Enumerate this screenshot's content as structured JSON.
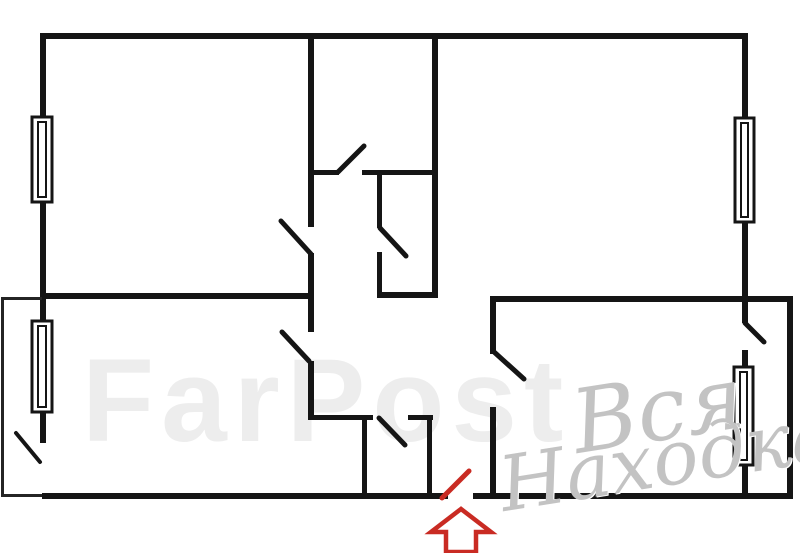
{
  "canvas": {
    "width": 800,
    "height": 553,
    "background": "#ffffff"
  },
  "colors": {
    "wall": "#151515",
    "balcony_line": "#242424",
    "entrance_red": "#c92b23",
    "logo_gray": "#c3c3c3",
    "faint_gray": "#ededed",
    "window_fill": "#ffffff"
  },
  "watermarks": {
    "faint_text": "FarPost",
    "logo_line1": "Вся",
    "logo_line2": "Находка"
  },
  "floorplan": {
    "walls": [
      {
        "x": 42,
        "y": 33,
        "w": 706,
        "h": 6
      },
      {
        "x": 40,
        "y": 33,
        "w": 6,
        "h": 410
      },
      {
        "x": 42,
        "y": 293,
        "w": 271,
        "h": 6
      },
      {
        "x": 308,
        "y": 33,
        "w": 6,
        "h": 194
      },
      {
        "x": 308,
        "y": 253,
        "w": 6,
        "h": 79
      },
      {
        "x": 308,
        "y": 361,
        "w": 6,
        "h": 59
      },
      {
        "x": 308,
        "y": 170,
        "w": 31,
        "h": 5
      },
      {
        "x": 362,
        "y": 170,
        "w": 75,
        "h": 5
      },
      {
        "x": 377,
        "y": 172,
        "w": 5,
        "h": 56
      },
      {
        "x": 377,
        "y": 252,
        "w": 5,
        "h": 46
      },
      {
        "x": 377,
        "y": 292,
        "w": 60,
        "h": 6
      },
      {
        "x": 432,
        "y": 33,
        "w": 6,
        "h": 265
      },
      {
        "x": 742,
        "y": 33,
        "w": 6,
        "h": 290
      },
      {
        "x": 742,
        "y": 350,
        "w": 6,
        "h": 145
      },
      {
        "x": 490,
        "y": 296,
        "w": 303,
        "h": 6
      },
      {
        "x": 490,
        "y": 296,
        "w": 6,
        "h": 58
      },
      {
        "x": 490,
        "y": 407,
        "w": 6,
        "h": 92
      },
      {
        "x": 787,
        "y": 298,
        "w": 6,
        "h": 201
      },
      {
        "x": 42,
        "y": 493,
        "w": 406,
        "h": 6
      },
      {
        "x": 473,
        "y": 493,
        "w": 320,
        "h": 6
      },
      {
        "x": 308,
        "y": 415,
        "w": 65,
        "h": 5
      },
      {
        "x": 408,
        "y": 415,
        "w": 25,
        "h": 5
      },
      {
        "x": 362,
        "y": 418,
        "w": 5,
        "h": 77
      },
      {
        "x": 427,
        "y": 415,
        "w": 5,
        "h": 84
      }
    ],
    "balcony_lines": [
      {
        "x": 1,
        "y": 297,
        "w": 3,
        "h": 200
      },
      {
        "x": 1,
        "y": 297,
        "w": 41,
        "h": 3
      },
      {
        "x": 1,
        "y": 494,
        "w": 41,
        "h": 3
      }
    ],
    "windows": [
      {
        "x": 32,
        "y": 117,
        "w": 20,
        "h": 85
      },
      {
        "x": 32,
        "y": 321,
        "w": 20,
        "h": 91
      },
      {
        "x": 735,
        "y": 118,
        "w": 19,
        "h": 104
      },
      {
        "x": 734,
        "y": 367,
        "w": 19,
        "h": 98
      }
    ],
    "door_leaves": [
      {
        "x1": 338,
        "y1": 172,
        "x2": 364,
        "y2": 146,
        "w": 5
      },
      {
        "x1": 281,
        "y1": 221,
        "x2": 311,
        "y2": 254,
        "w": 5
      },
      {
        "x1": 380,
        "y1": 228,
        "x2": 406,
        "y2": 256,
        "w": 5
      },
      {
        "x1": 282,
        "y1": 332,
        "x2": 309,
        "y2": 361,
        "w": 5
      },
      {
        "x1": 379,
        "y1": 418,
        "x2": 405,
        "y2": 445,
        "w": 5
      },
      {
        "x1": 493,
        "y1": 351,
        "x2": 524,
        "y2": 379,
        "w": 5
      },
      {
        "x1": 745,
        "y1": 323,
        "x2": 764,
        "y2": 342,
        "w": 5
      },
      {
        "x1": 16,
        "y1": 433,
        "x2": 40,
        "y2": 462,
        "w": 4
      }
    ],
    "entrance": {
      "leaf": {
        "x1": 442,
        "y1": 498,
        "x2": 469,
        "y2": 471,
        "w": 5
      },
      "arrow_path": "M461 509 L431 532 L446 532 L446 552 L476 552 L476 532 L491 532 Z",
      "arrow_stroke_width": 4.5
    }
  }
}
